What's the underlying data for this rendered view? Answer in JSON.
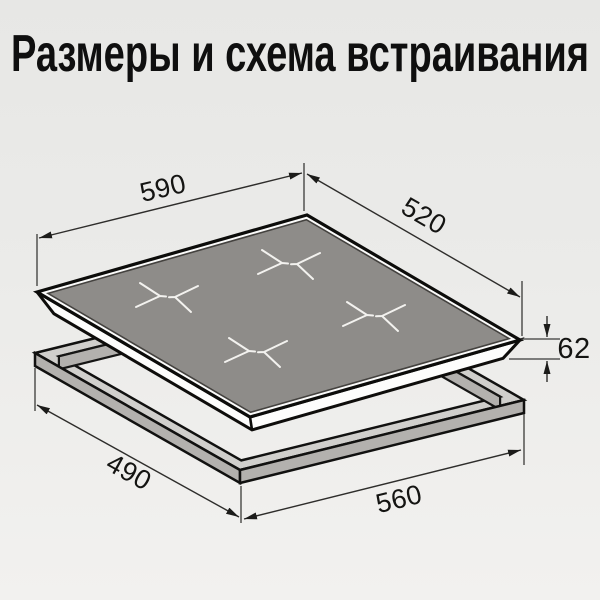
{
  "title": "Размеры и схема встраивания",
  "diagram": {
    "description": "isometric dimensions and built-in installation scheme of a 4-zone hob over a worktop cutout frame",
    "dimensions_mm": {
      "hob_width": "590",
      "hob_depth": "520",
      "hob_height": "62",
      "cutout_depth": "490",
      "cutout_width": "560"
    },
    "burner_zone_count": 4,
    "colors": {
      "background": "#ebebe9",
      "glass_surface": "#8e8c89",
      "hob_edge": "#fbfbfa",
      "frame_top": "#d0cfcc",
      "frame_side": "#b3b1ae",
      "line": "#0e0d0b",
      "dimension_line": "#2e2d2b",
      "zone_marking": "#f3f2ef"
    }
  }
}
